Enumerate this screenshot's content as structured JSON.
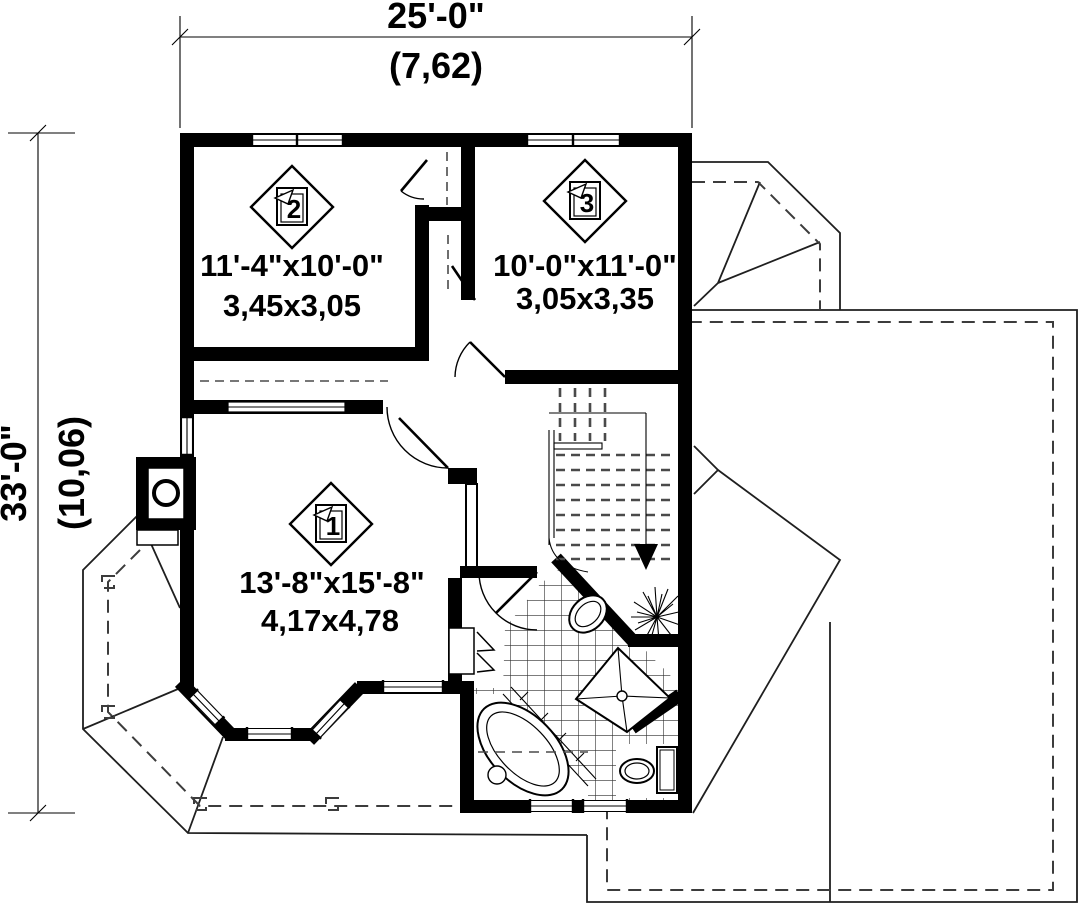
{
  "drawing": {
    "type": "floor-plan",
    "dimensions": {
      "top": {
        "imperial": "25'-0\"",
        "metric": "(7,62)"
      },
      "left": {
        "imperial": "33'-0\"",
        "metric": "(10,06)"
      }
    },
    "rooms": [
      {
        "number": "1",
        "size_imperial": "13'-8\"x15'-8\"",
        "size_metric": "4,17x4,78"
      },
      {
        "number": "2",
        "size_imperial": "11'-4\"x10'-0\"",
        "size_metric": "3,45x3,05"
      },
      {
        "number": "3",
        "size_imperial": "10'-0\"x11'-0\"",
        "size_metric": "3,05x3,35"
      }
    ],
    "colors": {
      "wall": "#000000",
      "background": "#ffffff",
      "roof_line": "#1f1f1f",
      "dashed_line": "#3c3c3c",
      "tile_line": "#2e2e2e"
    }
  }
}
